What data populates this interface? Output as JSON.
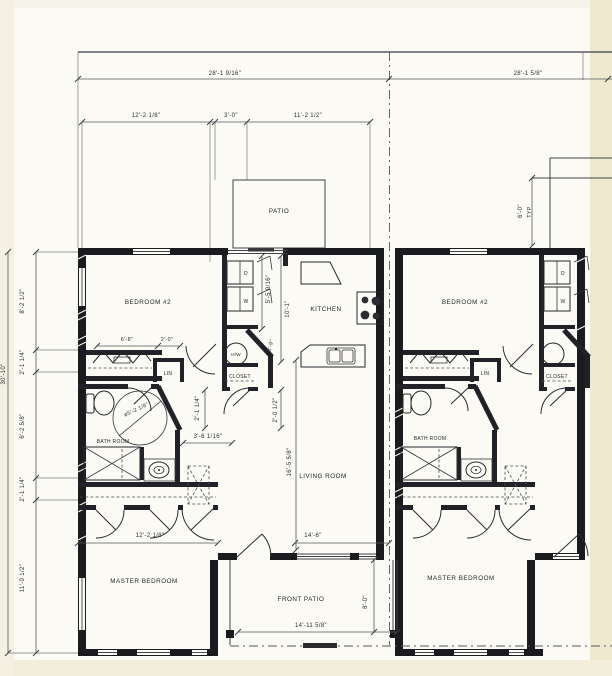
{
  "rooms": {
    "patio": "PATIO",
    "bedroom2": "BEDROOM #2",
    "kitchen": "KITCHEN",
    "living": "LIVING ROOM",
    "bath": "BATH ROOM",
    "master": "MASTER BEDROOM",
    "front_patio": "FRONT PATIO",
    "closet": "CLOSET",
    "lin": "LIN",
    "hw_heater": "H/W",
    "dryer": "D",
    "washer": "W"
  },
  "dims": {
    "overall_left": "28'-1 9/16\"",
    "overall_right": "28'-1 5/8\"",
    "bedroom_width": "12'-2 1/8\"",
    "patio_door": "3'-0\"",
    "kitchen_bay": "11'-2 1/2\"",
    "side_1": "8'-2 1/2\"",
    "side_2": "2'-1 1/4\"",
    "side_3": "6'-2 5/8\"",
    "side_4": "2'-1 1/4\"",
    "side_5": "11'-9 1/2\"",
    "side_total": "30'-10\"",
    "closet_w1": "6'-8\"",
    "closet_w2": "2'-0\"",
    "utility_h": "5'-5 9/16\"",
    "kitchen_depth": "10'-1\"",
    "wh_closet": "3'-9\"",
    "hall_w": "2'-1 1/4\"",
    "closet_d": "2'-0 1/2\"",
    "bath_w": "3'-6 1/16\"",
    "bath_turn": "ø5'-2 1/8\"",
    "living_depth": "16'-5 5/8\"",
    "living_width": "14'-6\"",
    "master_width": "12'-2 1/8\"",
    "front_patio_w": "14'-11 5/8\"",
    "front_patio_d": "8'-0\"",
    "patio_depth": "6'-0\"",
    "typ": "TYP"
  }
}
